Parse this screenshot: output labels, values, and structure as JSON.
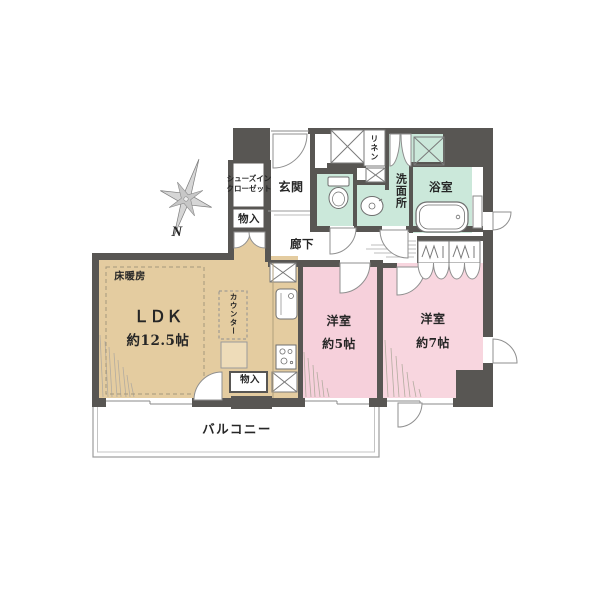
{
  "floorplan": {
    "colors": {
      "wall": "#585653",
      "mint": "#cbe8da",
      "pink_5": "#f6d0db",
      "pink_7": "#f8d6df",
      "beige": "#e4cca0",
      "beige_light": "#eedcb9",
      "arc_stroke": "#8f8f8f",
      "thin_line": "#9a9a9a"
    },
    "compass": {
      "north_label": "N"
    },
    "labels": {
      "shoes_closet_line1": "シューズイン",
      "shoes_closet_line2": "クローゼット",
      "storage_upper": "物入",
      "entrance": "玄関",
      "linen": "リネン",
      "washroom": "洗面所",
      "bathroom": "浴室",
      "corridor": "廊下",
      "floor_heating": "床暖房",
      "ldk_name": "ＬＤＫ",
      "ldk_size": "約12.5帖",
      "counter": "カウンター",
      "storage_lower": "物入",
      "bedroom5_name": "洋室",
      "bedroom5_size": "約5帖",
      "bedroom7_name": "洋室",
      "bedroom7_size": "約7帖",
      "balcony": "バルコニー"
    }
  }
}
